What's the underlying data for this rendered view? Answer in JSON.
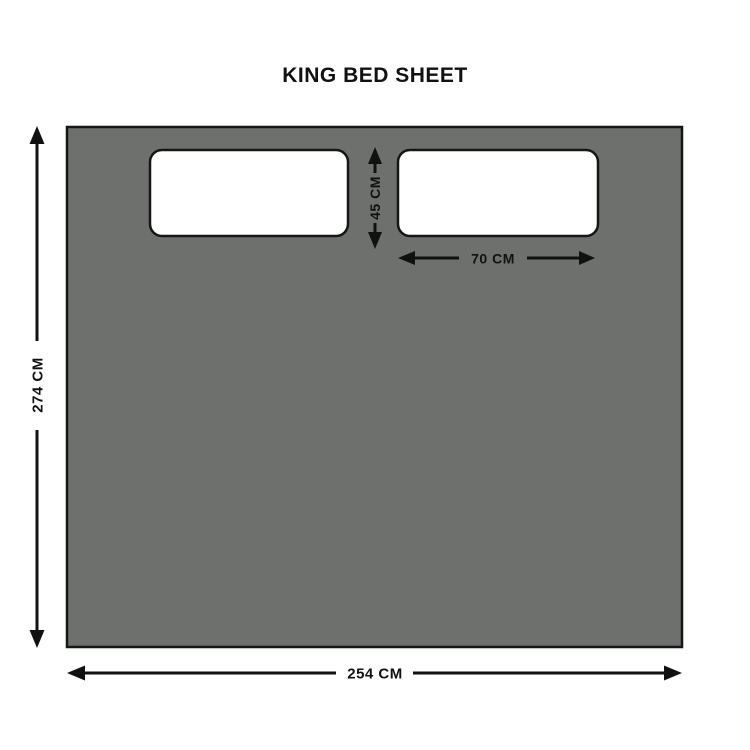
{
  "title": "KING BED SHEET",
  "labels": {
    "sheet_height": "274 CM",
    "sheet_width": "254 CM",
    "pillow_height": "45 CM",
    "pillow_width": "70 CM"
  },
  "colors": {
    "background": "#ffffff",
    "sheet_fill": "#6d706d",
    "outline": "#161616",
    "pillow_fill": "#ffffff",
    "dimension": "#111111"
  }
}
